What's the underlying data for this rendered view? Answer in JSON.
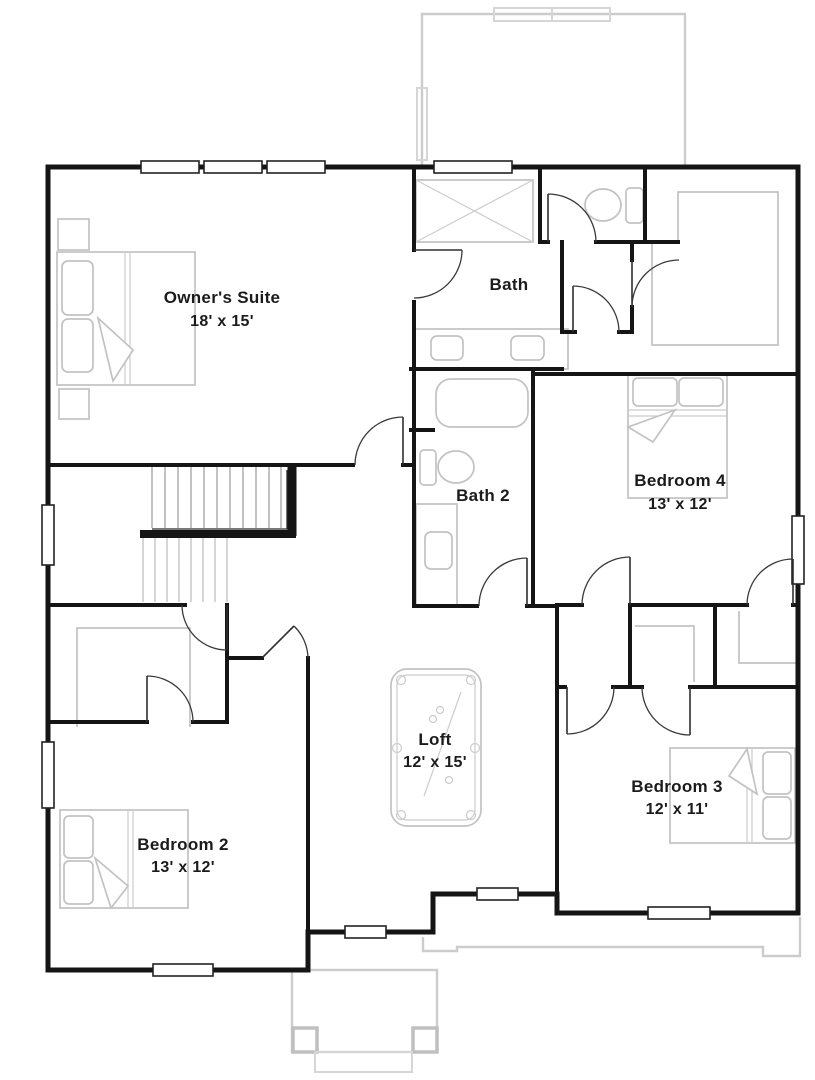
{
  "floor_plan": {
    "type": "residential-second-floor-plan",
    "colors": {
      "background": "#ffffff",
      "wall": "#151515",
      "door": "#2e2e2e",
      "window_fill": "#ffffff",
      "fixture": "#c2c2c2",
      "ghost_outline": "#cccccc",
      "stair_tread": "#9a9a9a",
      "label_text": "#1b1b1b"
    },
    "rooms": [
      {
        "id": "owners-suite",
        "name": "Owner's Suite",
        "dimensions": "18' x 15'"
      },
      {
        "id": "bath",
        "name": "Bath"
      },
      {
        "id": "bath-2",
        "name": "Bath 2"
      },
      {
        "id": "bedroom-4",
        "name": "Bedroom 4",
        "dimensions": "13' x 12'"
      },
      {
        "id": "loft",
        "name": "Loft",
        "dimensions": "12' x 15'"
      },
      {
        "id": "bedroom-2",
        "name": "Bedroom 2",
        "dimensions": "13' x 12'"
      },
      {
        "id": "bedroom-3",
        "name": "Bedroom 3",
        "dimensions": "12' x 11'"
      }
    ],
    "fixture_icons": [
      "bed-icon",
      "pool-table-icon",
      "shower-icon",
      "bathtub-icon",
      "toilet-icon",
      "sink-icon",
      "vanity-icon",
      "closet-shelf-icon",
      "staircase-icon",
      "window",
      "door-swing"
    ]
  }
}
